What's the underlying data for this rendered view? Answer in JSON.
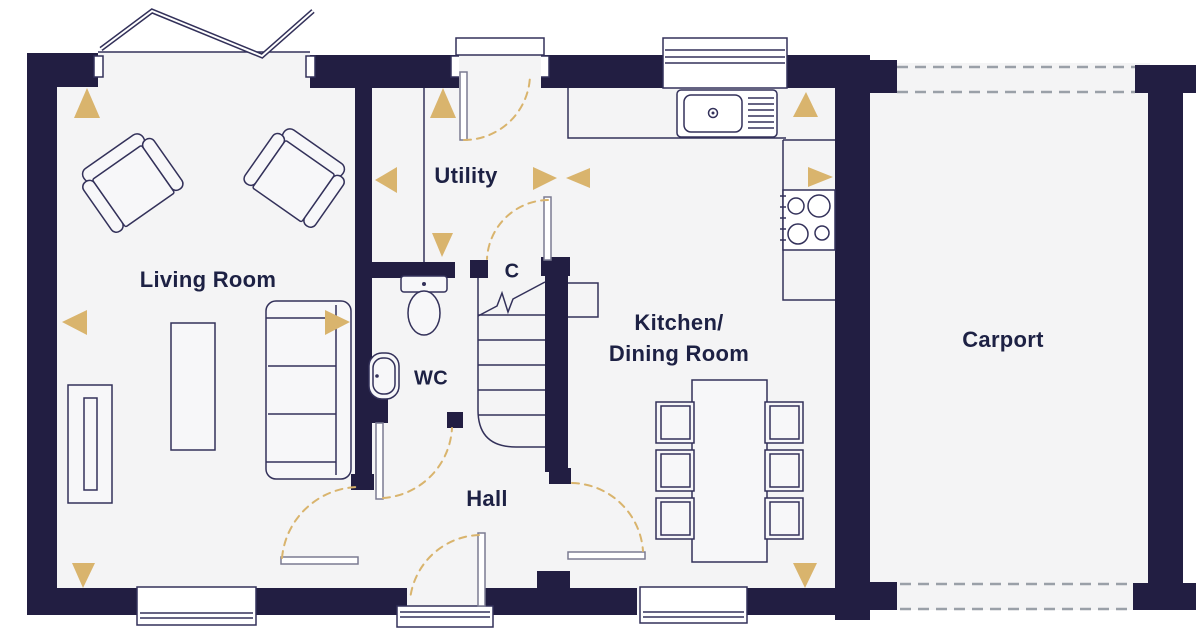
{
  "colors": {
    "wall": "#221e42",
    "floor": "#f4f4f5",
    "line": "#33315a",
    "accent": "#d9b46d",
    "dash": "#9aa0a8",
    "text": "#1d2144"
  },
  "rooms": {
    "living_room": {
      "label": "Living Room"
    },
    "utility": {
      "label": "Utility"
    },
    "wc": {
      "label": "WC"
    },
    "cupboard": {
      "label": "C"
    },
    "hall": {
      "label": "Hall"
    },
    "kitchen_dining": {
      "label_line1": "Kitchen/",
      "label_line2": "Dining Room"
    },
    "carport": {
      "label": "Carport"
    }
  },
  "icons": [
    "armchair",
    "armchair",
    "sofa",
    "coffee-table",
    "tv-unit",
    "dining-table",
    "dining-chair",
    "dining-chair",
    "dining-chair",
    "dining-chair",
    "dining-chair",
    "dining-chair",
    "toilet",
    "basin",
    "sink-drainer",
    "hob",
    "stairs",
    "door-swing-arc",
    "window",
    "direction-arrow"
  ]
}
